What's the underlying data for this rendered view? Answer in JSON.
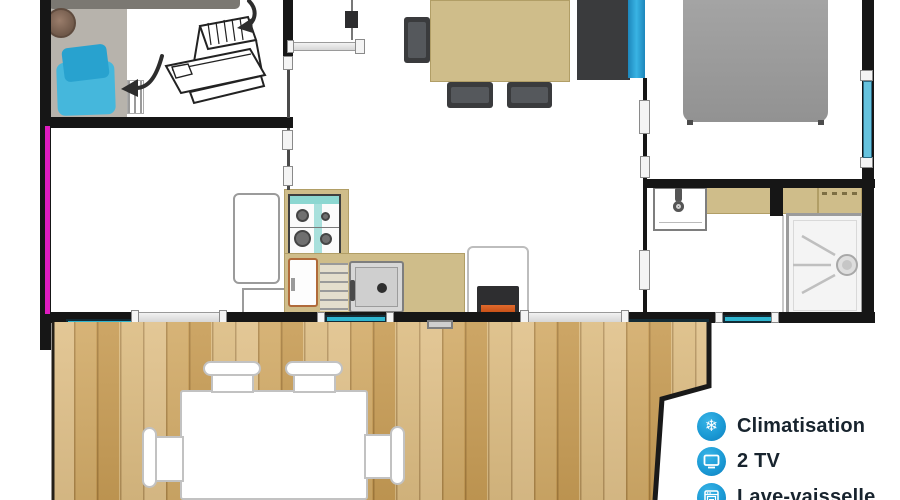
{
  "legend": {
    "items": [
      {
        "name": "climatisation",
        "icon": "snowflake-icon",
        "glyph": "❄",
        "label": "Climatisation"
      },
      {
        "name": "tv",
        "icon": "tv-icon",
        "label": "2 TV"
      },
      {
        "name": "lave-vaisselle",
        "icon": "dishwasher-icon",
        "label": "Lave-vaisselle"
      }
    ]
  },
  "colors": {
    "wall": "#161616",
    "rug": "#b7b3ac",
    "sofa": "#7b7872",
    "cushion": "#45b7dc",
    "pillow": "#28a2cf",
    "magenta": "#df1cbf",
    "tan": "#cfbd8a",
    "tan_dark": "#b19e66",
    "furniture_dark": "#3a3b3d",
    "furniture_mid": "#55585c",
    "wardrobe_blue": "#2495c9",
    "bed_gray": "#9b9b9b",
    "window_teal": "#2fb5cf",
    "window_navy": "#132b35",
    "window_sky": "#66c3de",
    "wood_a": "#e0c18a",
    "wood_b": "#d2ab68",
    "wood_c": "#c79c55",
    "stove_teal": "#8cd7d1",
    "burner": "#6f6f6f",
    "sink_gray": "#d7d7d7",
    "orange": "#d95c22",
    "legend_blue": "#1b9ad5",
    "legend_text": "#18242e"
  }
}
